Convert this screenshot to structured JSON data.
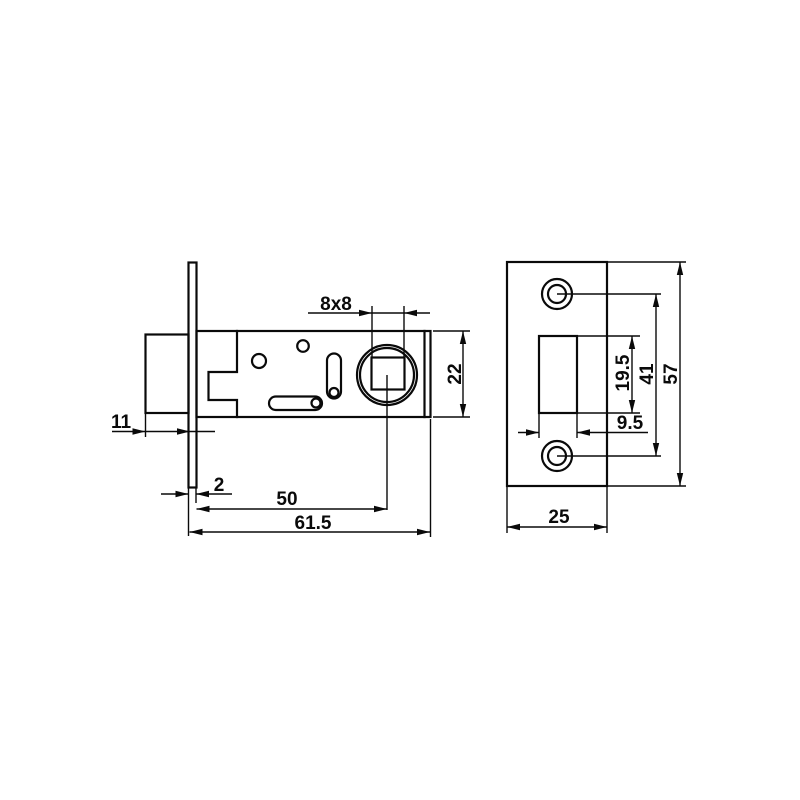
{
  "title": "Tubular latch technical drawing",
  "colors": {
    "background": "#ffffff",
    "line": "#0a0a0a"
  },
  "side_view": {
    "dims": {
      "spindle_hole": "8x8",
      "case_height": "22",
      "bolt_protrusion": "11",
      "faceplate_thickness": "2",
      "backset": "50",
      "case_length": "61.5"
    }
  },
  "front_view": {
    "dims": {
      "cutout_height": "19.5",
      "screw_spacing": "41",
      "plate_height": "57",
      "cutout_width": "9.5",
      "plate_width": "25"
    }
  }
}
